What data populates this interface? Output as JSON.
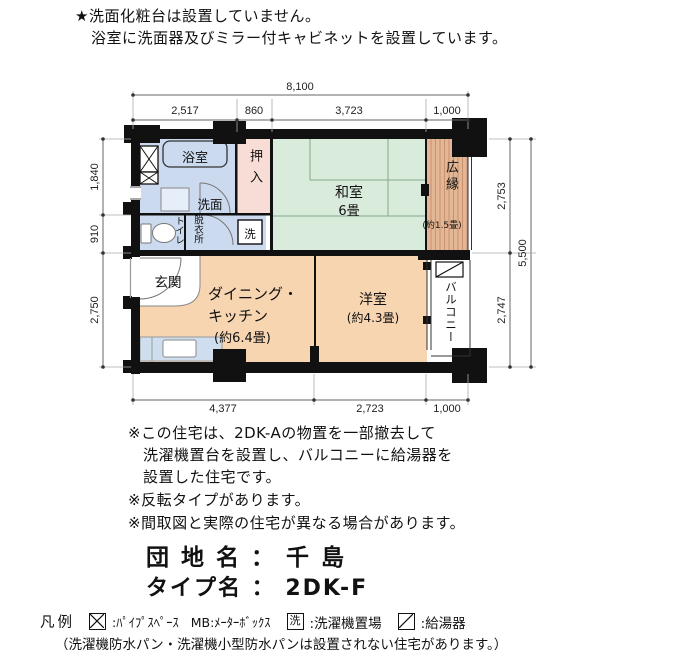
{
  "header": {
    "line1": "★洗面化粧台は設置していません。",
    "line2": "浴室に洗面器及びミラー付キャビネットを設置しています。"
  },
  "plan": {
    "rooms": {
      "bath": "浴室",
      "senmen": "洗面",
      "toilet": "トイレ",
      "dressing": "脱衣所",
      "washer": "洗",
      "closet": "押入",
      "washitsu": "和室",
      "washitsu_size": "6畳",
      "hiroen": "広縁",
      "hiroen_size": "(約1.5畳)",
      "genkan": "玄関",
      "dk1": "ダイニング・",
      "dk2": "キッチン",
      "dk_size": "(約6.4畳)",
      "yoshitsu": "洋室",
      "yoshitsu_size": "(約4.3畳)",
      "balcony": "バルコニー"
    },
    "dims": {
      "top_total": "8,100",
      "top": [
        "2,517",
        "860",
        "3,723",
        "1,000"
      ],
      "bottom": [
        "4,377",
        "2,723",
        "1,000"
      ],
      "left": [
        "1,840",
        "910",
        "2,750"
      ],
      "right": [
        "2,753",
        "2,747"
      ],
      "right_total": "5,500"
    }
  },
  "notes": [
    "※この住宅は、2DK-Aの物置を一部撤去して",
    "洗濯機置台を設置し、バルコニーに給湯器を",
    "設置した住宅です。",
    "※反転タイプがあります。",
    "※間取図と実際の住宅が異なる場合があります。"
  ],
  "estate": {
    "danchi_line": "団 地 名 ： 千 島",
    "type_line": "タイプ名 ： 2DK-F"
  },
  "legend": {
    "title": "凡例",
    "ps_text": ":ﾊﾟｲﾌﾟｽﾍﾟｰｽ",
    "mb_text": "MB:ﾒｰﾀｰﾎﾞｯｸｽ",
    "washer_symbol": "洗",
    "washer_text": ":洗濯機置場",
    "heater_text": ":給湯器",
    "footnote": "（洗濯機防水パン・洗濯機小型防水パンは設置されない住宅があります。）"
  },
  "colors": {
    "wall": "#111111",
    "water_rooms": "#cbdaee",
    "tatami_room": "#d9ebda",
    "closet": "#f8ddd6",
    "wood_veranda": "#dfb392",
    "flooring": "#f8d5b1"
  }
}
